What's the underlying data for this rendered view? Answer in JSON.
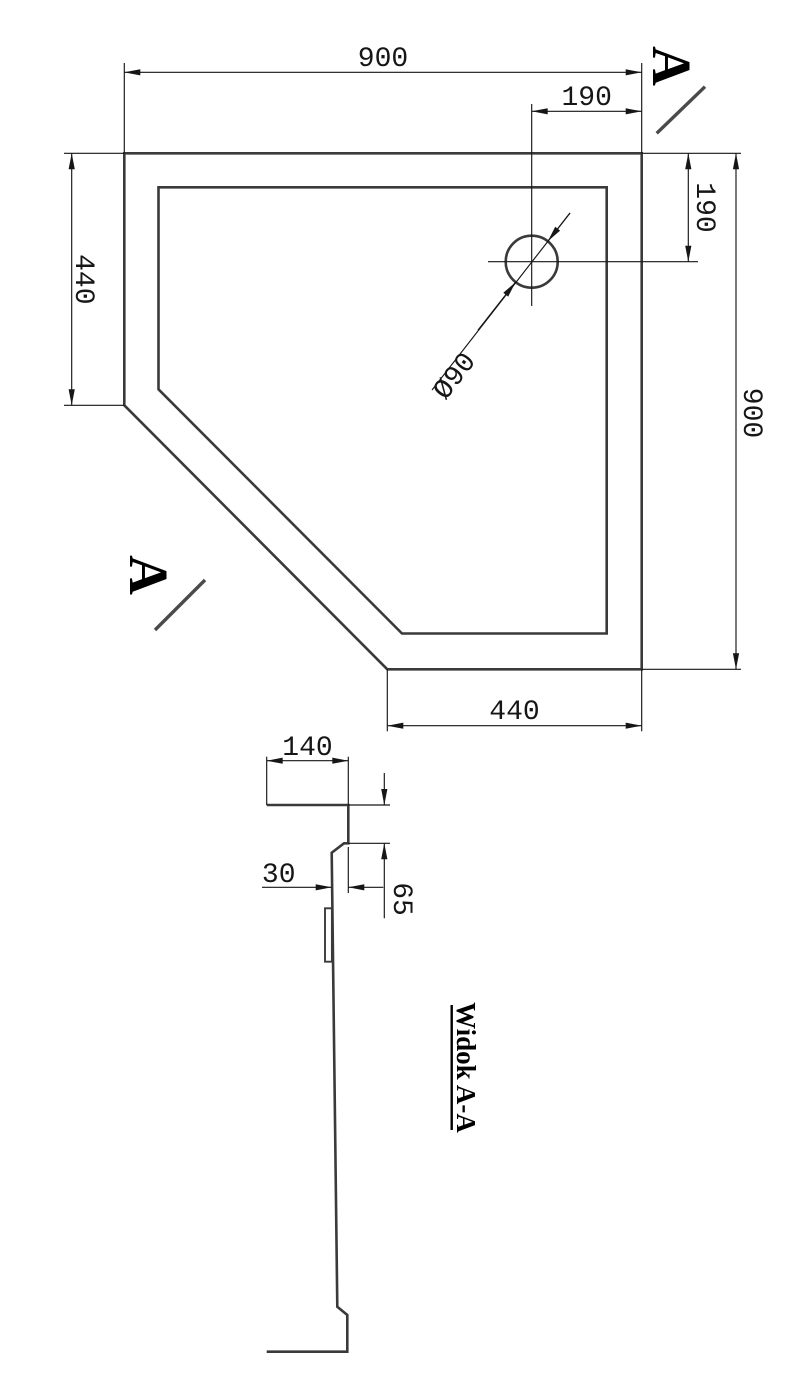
{
  "plan_view": {
    "dim_top_width": "900",
    "dim_right_height": "900",
    "dim_left_side": "440",
    "dim_bottom_side": "440",
    "dim_drain_from_right_top": "190",
    "dim_drain_from_top_right": "190",
    "drain_diameter_label": "Ø90"
  },
  "section_view": {
    "dim_rim_width": "140",
    "dim_rim_height": "65",
    "dim_wall_inset": "30",
    "caption": "Widok A-A"
  },
  "section_markers": {
    "label_top_right": "A",
    "label_left": "A"
  },
  "colors": {
    "background": "#ffffff",
    "outline": "#3a3a3a",
    "dimension": "#161616",
    "text": "#000000"
  }
}
